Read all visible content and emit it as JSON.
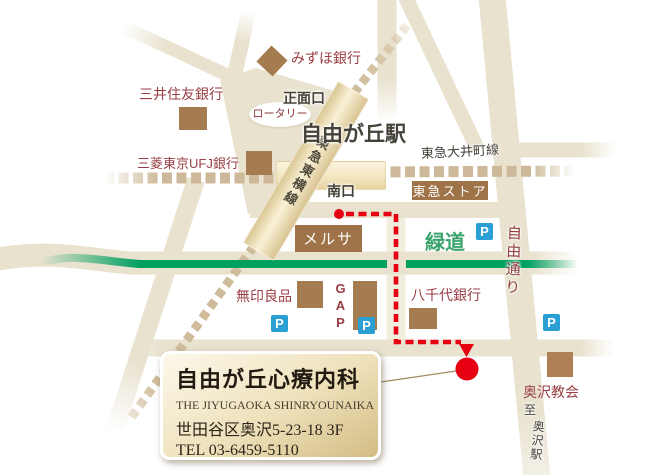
{
  "map": {
    "station_area": {
      "station": "自由が丘駅",
      "front_exit": "正面口",
      "south_exit": "南口",
      "rotary": "ロータリー"
    },
    "rail": {
      "toyoko_line": "東急東横線",
      "oimachi_line": "東急大井町線"
    },
    "streets": {
      "jiyu_dori": "自由通り",
      "ryokudo": "緑道",
      "to_okusawa_prefix": "至",
      "to_okusawa_station": "奥沢駅"
    },
    "places": {
      "mizuho": "みずほ銀行",
      "smbc": "三井住友銀行",
      "ufj": "三菱東京UFJ銀行",
      "tokyu_store": "東急ストア",
      "melsa": "メルサ",
      "muji": "無印良品",
      "gap": "GAP",
      "yachiyo": "八千代銀行",
      "church": "奥沢教会"
    },
    "parking_label": "P",
    "colors": {
      "road": "#e8e2cf",
      "road_light": "#f2eedd",
      "rail_dash": "#cdb999",
      "building_brown": "#a57c4f",
      "store_box_brown": "#9f7348",
      "text_maroon": "#993e44",
      "text_dark": "#45423a",
      "green_way": "#00a061",
      "green_text": "#3aa36c",
      "parking_blue": "#2a9fd3",
      "route_red": "#e60012"
    }
  },
  "clinic": {
    "title": "自由が丘心療内科",
    "subtitle": "THE JIYUGAOKA SHINRYOUNAIKA",
    "address": "世田谷区奥沢5-23-18 3F",
    "tel": "TEL 03-6459-5110"
  }
}
